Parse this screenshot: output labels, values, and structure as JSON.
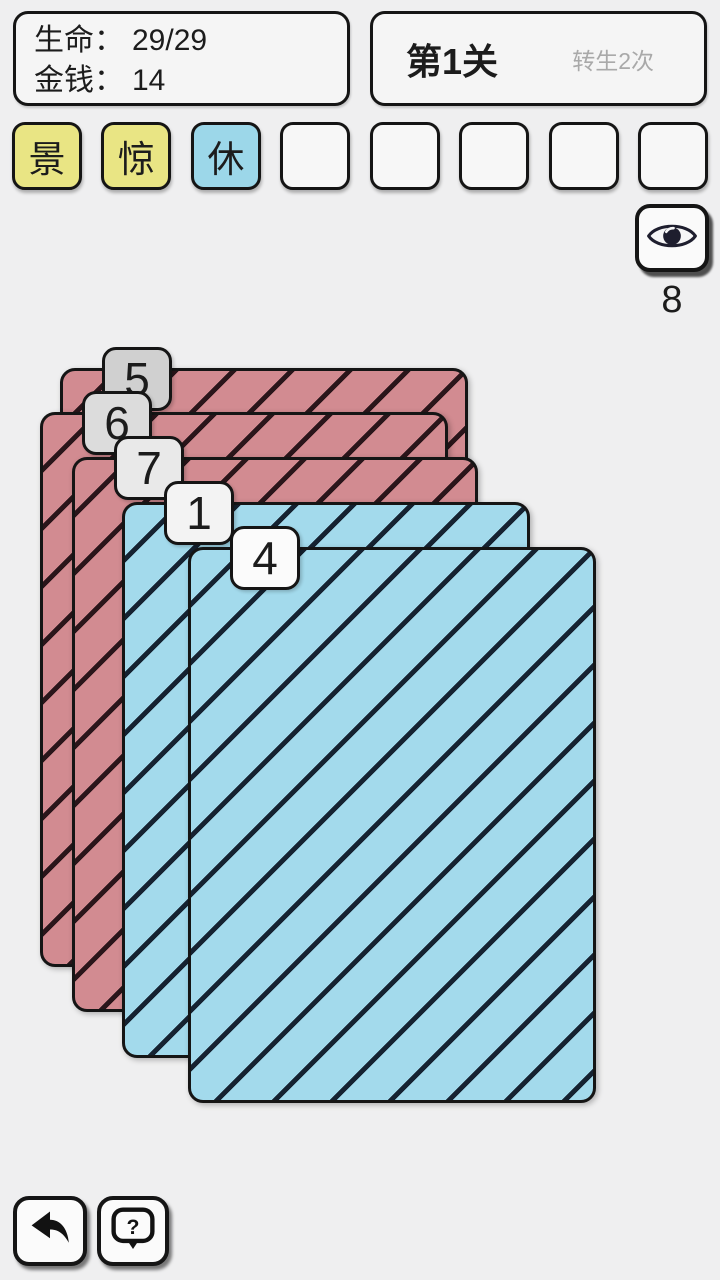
{
  "colors": {
    "page-bg": "#efeff0",
    "panel-bg": "#f5f5f5",
    "border": "#151515",
    "text": "#1c1c1c",
    "muted-text": "#a9a9a9",
    "card-red": "#d28b91",
    "stripe-red": "#2a151a",
    "card-blue": "#a3daec",
    "stripe-blue": "#152231"
  },
  "stats": {
    "life_label": "生命：",
    "life_value": "29/29",
    "money_label": "金钱：",
    "money_value": "14"
  },
  "level": {
    "title": "第1关",
    "rebirth_note": "转生2次"
  },
  "hand_slots": [
    {
      "label": "景",
      "color": "#e9e584"
    },
    {
      "label": "惊",
      "color": "#e9e584"
    },
    {
      "label": "休",
      "color": "#9cd7e9"
    },
    {
      "label": "",
      "color": "#f7f7f7"
    },
    {
      "label": "",
      "color": "#f7f7f7"
    },
    {
      "label": "",
      "color": "#f7f7f7"
    },
    {
      "label": "",
      "color": "#f7f7f7"
    },
    {
      "label": "",
      "color": "#f7f7f7"
    }
  ],
  "peek": {
    "icon": "eye-icon",
    "count": "8"
  },
  "cards": [
    {
      "number": "5",
      "type": "red",
      "tab_color": "#d0d0d0",
      "left": 60,
      "top": 368,
      "width": 408,
      "height": 555
    },
    {
      "number": "6",
      "type": "red",
      "tab_color": "#dcdcdc",
      "left": 40,
      "top": 412,
      "width": 408,
      "height": 555
    },
    {
      "number": "7",
      "type": "red",
      "tab_color": "#e9e9e9",
      "left": 72,
      "top": 457,
      "width": 406,
      "height": 555
    },
    {
      "number": "1",
      "type": "blue",
      "tab_color": "#f3f3f3",
      "left": 122,
      "top": 502,
      "width": 408,
      "height": 556
    },
    {
      "number": "4",
      "type": "blue",
      "tab_color": "#fbfbfb",
      "left": 188,
      "top": 547,
      "width": 408,
      "height": 556
    }
  ],
  "footer": {
    "back_icon": "back-arrow-icon",
    "help_icon": "question-bubble-icon"
  }
}
